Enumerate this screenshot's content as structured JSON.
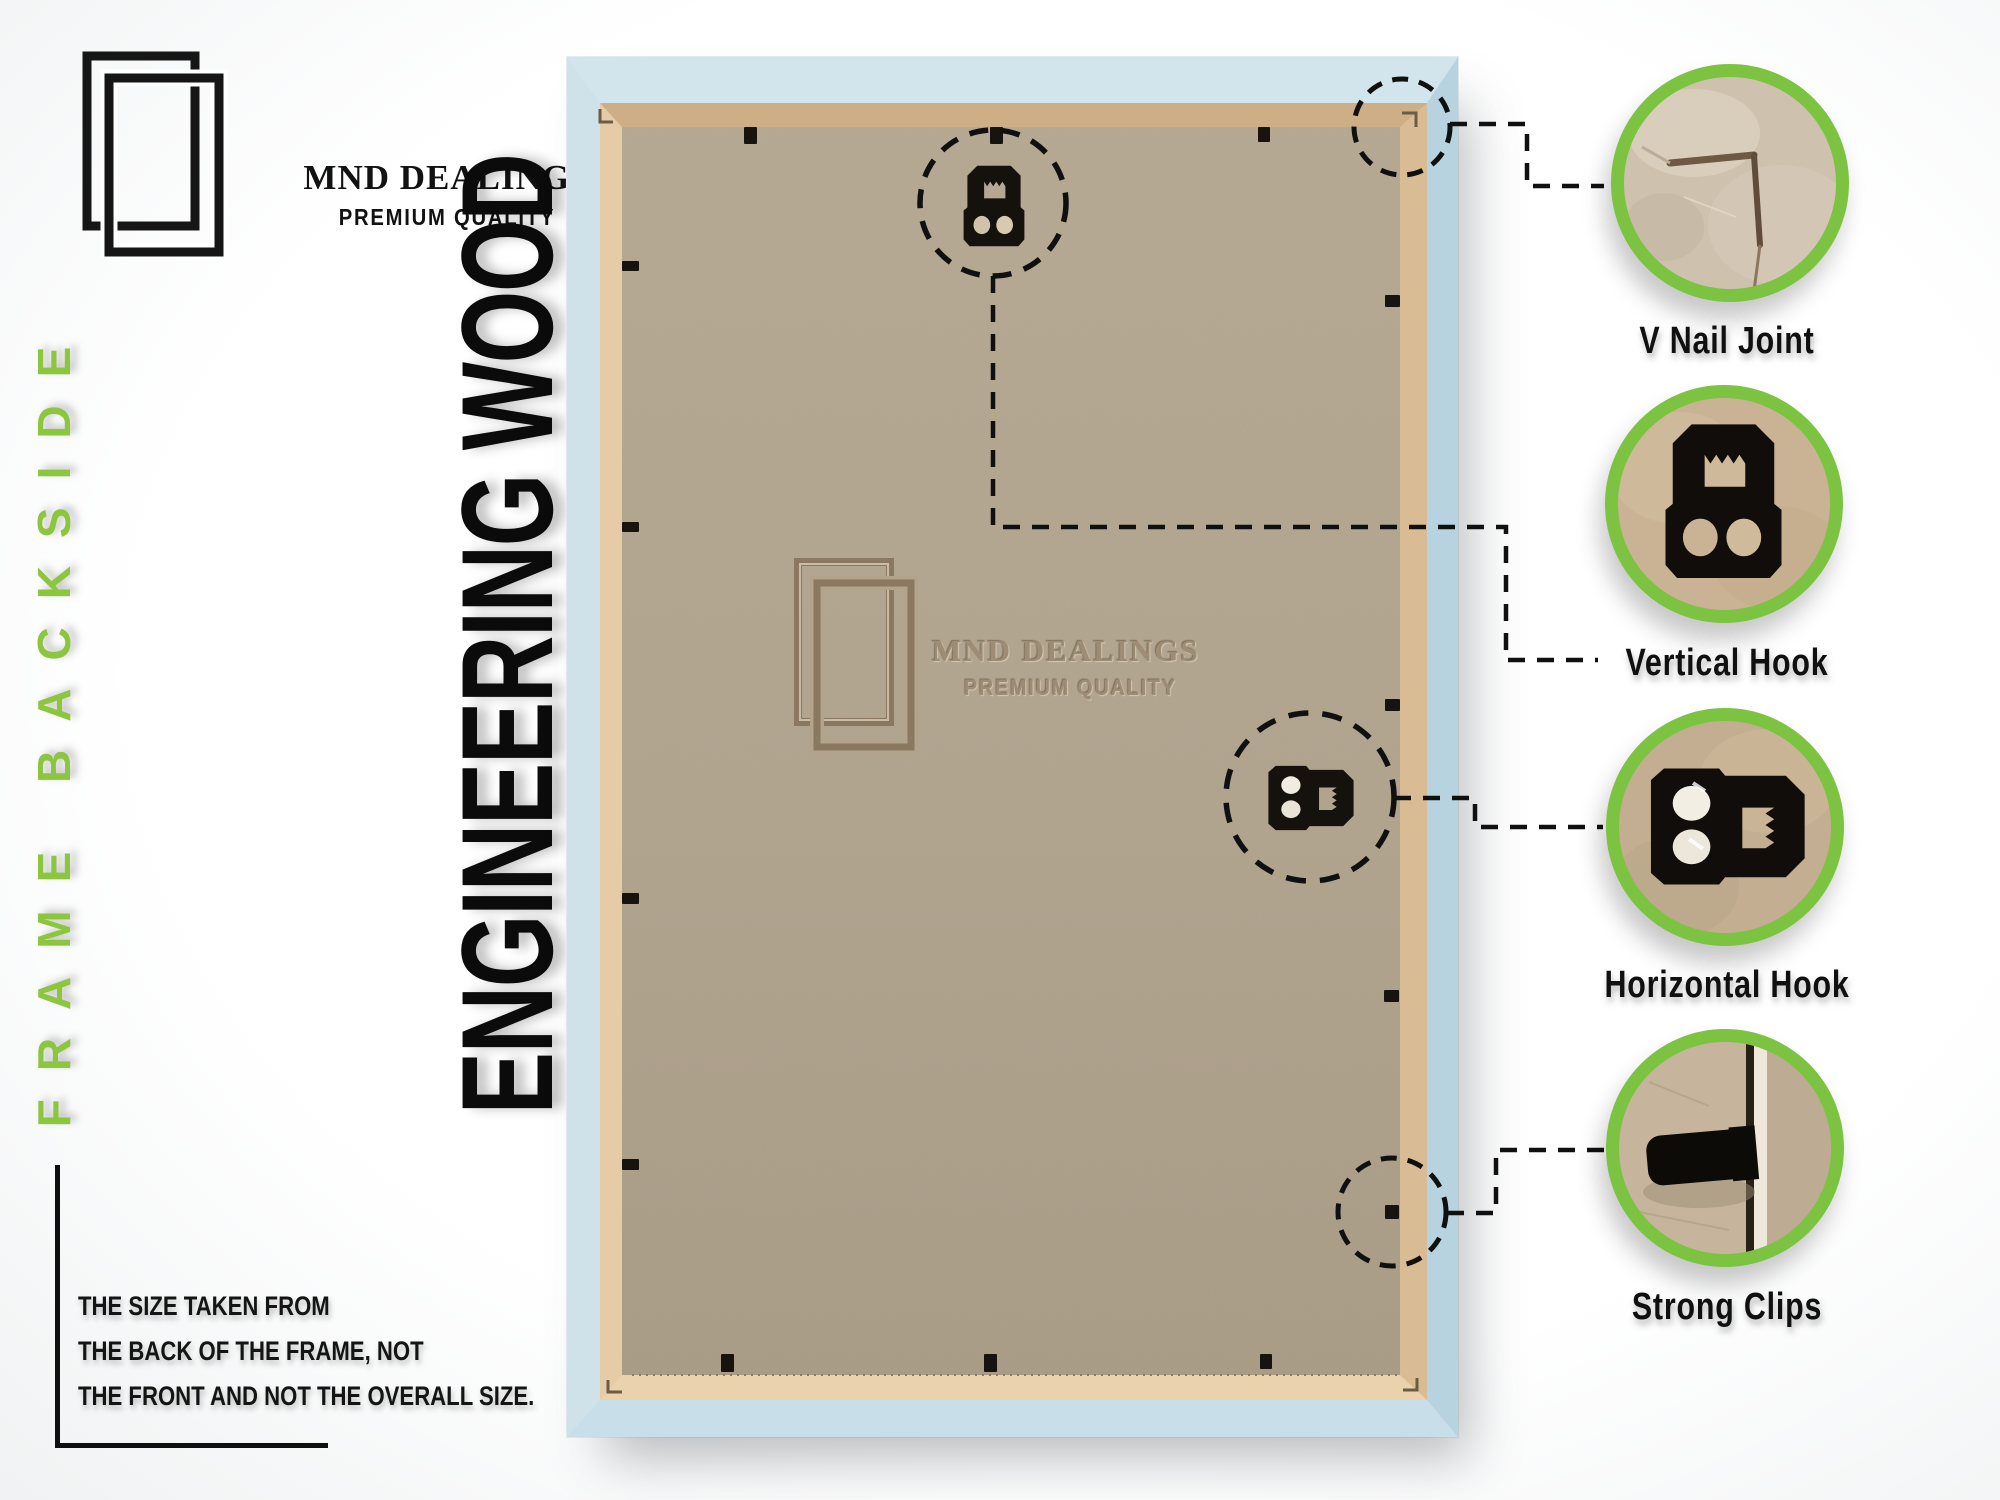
{
  "brand": {
    "name": "MND DEALINGS",
    "tagline": "PREMIUM QUALITY"
  },
  "side_label": "FRAME BACKSIDE",
  "material_label": "ENGINEERING WOOD",
  "note_lines": {
    "line1": "THE SIZE TAKEN FROM",
    "line2": "THE BACK OF THE FRAME, NOT",
    "line3": "THE FRONT AND NOT THE OVERALL SIZE."
  },
  "watermark": {
    "name": "MND DEALINGS",
    "tagline": "PREMIUM QUALITY"
  },
  "callouts": [
    {
      "label": "V Nail Joint",
      "icon": "v-nail-joint-photo"
    },
    {
      "label": "Vertical Hook",
      "icon": "vertical-hook-photo"
    },
    {
      "label": "Horizontal Hook",
      "icon": "horizontal-hook-photo"
    },
    {
      "label": "Strong Clips",
      "icon": "strong-clip-photo"
    }
  ],
  "colors": {
    "accent_green": "#7cc342",
    "side_label_green": "#8cc63e",
    "frame_blue": "#cfe2ea",
    "frame_blue_dark": "#b7d3df",
    "wood_tan": "#e2c9a3",
    "wood_tan_dark": "#cdae85",
    "mdf": "#b2a58f",
    "watermark_brown": "#9e8c74",
    "ink": "#121212"
  }
}
